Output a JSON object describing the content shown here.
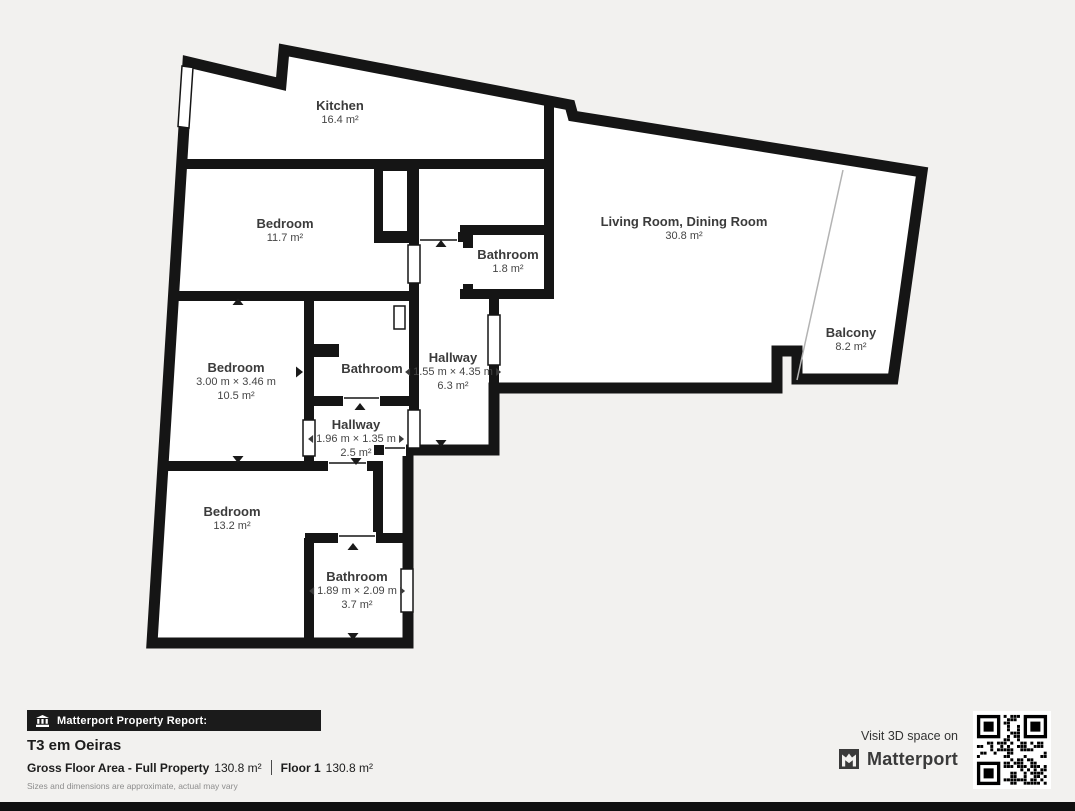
{
  "plan": {
    "rooms": [
      {
        "name": "Kitchen",
        "area": "16.4 m²"
      },
      {
        "name": "Bedroom",
        "area": "11.7 m²"
      },
      {
        "name": "Living Room, Dining Room",
        "area": "30.8 m²"
      },
      {
        "name": "Balcony",
        "area": "8.2 m²"
      },
      {
        "name": "Bathroom",
        "area": "1.8 m²"
      },
      {
        "name": "Bedroom",
        "dims": "3.00 m × 3.46 m",
        "area": "10.5 m²"
      },
      {
        "name": "Bathroom"
      },
      {
        "name": "Hallway",
        "dims": "1.55 m × 4.35 m",
        "area": "6.3 m²"
      },
      {
        "name": "Hallway",
        "dims": "1.96 m × 1.35 m",
        "area": "2.5 m²"
      },
      {
        "name": "Bedroom",
        "area": "13.2 m²"
      },
      {
        "name": "Bathroom",
        "dims": "1.89 m × 2.09 m",
        "area": "3.7 m²"
      }
    ]
  },
  "footer": {
    "report_label": "Matterport Property Report:",
    "property_title": "T3 em Oeiras",
    "gfa_label": "Gross Floor Area - Full Property",
    "gfa_value": "130.8 m²",
    "floor_label": "Floor 1",
    "floor_value": "130.8 m²",
    "disclaimer": "Sizes and dimensions are approximate, actual may vary"
  },
  "promo": {
    "visit_label": "Visit 3D space on",
    "brand": "Matterport"
  },
  "colors": {
    "background": "#f2f1ef",
    "wall": "#151515",
    "floor": "#ffffff",
    "label_text": "#3f3f3f",
    "badge_bg": "#1b1b1b",
    "muted_text": "#8d8d8d"
  }
}
